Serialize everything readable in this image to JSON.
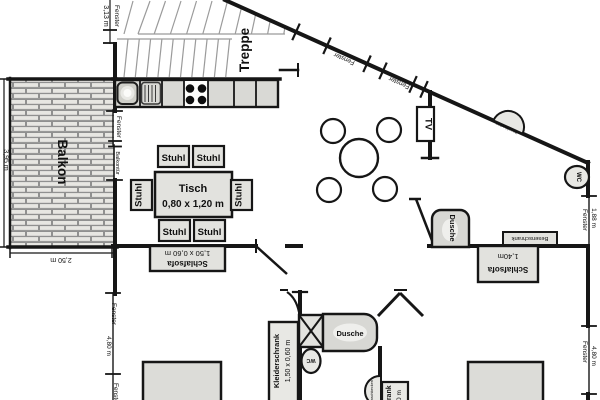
{
  "plan": {
    "type": "apartment floor plan",
    "rooms": {
      "balcony": "Balkon",
      "stairs": "Treppe"
    },
    "kitchen_dining": {
      "chair": "Stuhl",
      "table": "Tisch",
      "table_size": "0,80 x 1,20 m"
    },
    "living": {
      "tv": "TV",
      "sofa": "Schlafsofa",
      "sofa_size": "1,50 x 0,60 m",
      "broom_closet": "Besenschrank"
    },
    "bath_upper": {
      "shower": "Dusche",
      "wc": "WC",
      "washbasin": "Waschbecken"
    },
    "bath_lower": {
      "shower": "Dusche",
      "wc": "WC",
      "washbasin": "Waschbecken"
    },
    "bedroom_right": {
      "sofa": "Schlafsofa",
      "sofa_size": "1,40m"
    },
    "bedroom_left": {
      "wardrobe": "Kleiderschrank",
      "wardrobe_size": "1,50 x 0,60 m",
      "closet": "Schrank",
      "closet_size": "0,60 m"
    },
    "dimensions": {
      "window": "Fenster",
      "balcony_door": "Balkontür",
      "top_left_window": "3,13 m",
      "balcony_depth": "3,95 m",
      "balcony_width": "2,50 m",
      "right_window_small": "1,88 m",
      "side_window": "4,80 m"
    },
    "colors": {
      "wall": "#161616",
      "furniture_fill": "#e2e2de",
      "counter_fill": "#d9d9d5",
      "bed_fill": "#dcdcd8",
      "brick_fill": "#ebeae6",
      "brick_line": "#909090",
      "stair_line": "#9b9b9b"
    }
  }
}
